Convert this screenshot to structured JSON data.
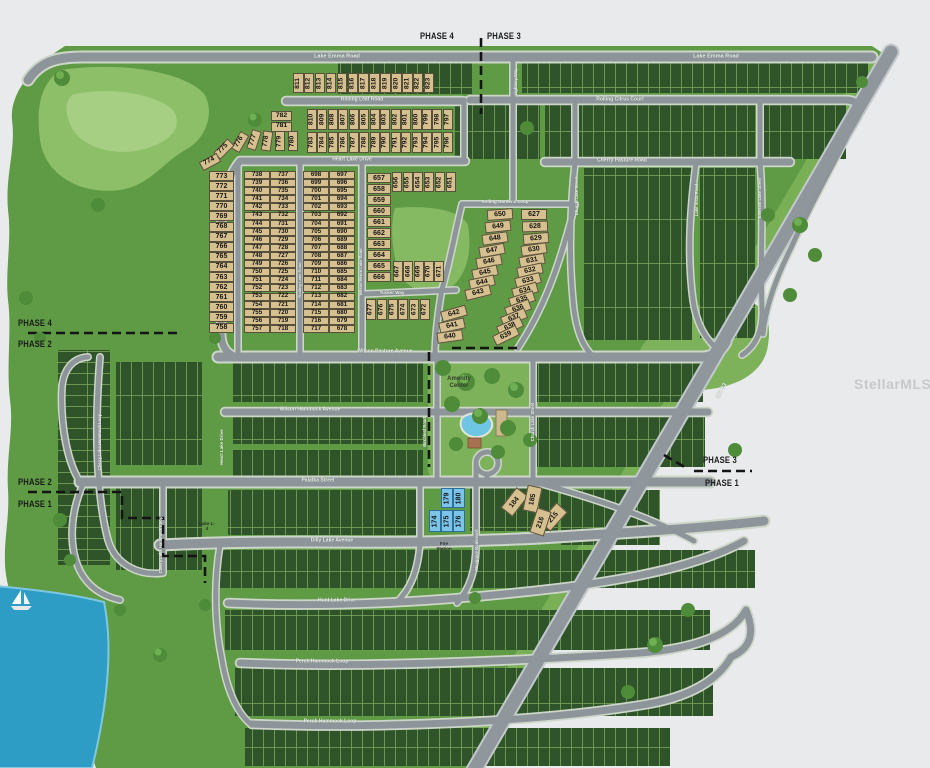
{
  "watermark": "StellarMLS",
  "phases": {
    "top": {
      "left": "PHASE 4",
      "right": "PHASE 3"
    },
    "left_upper": {
      "top": "PHASE 4",
      "bottom": "PHASE 2"
    },
    "left_lower": {
      "top": "PHASE 2",
      "bottom": "PHASE 1"
    },
    "right": {
      "top": "PHASE 3",
      "bottom": "PHASE 1"
    }
  },
  "legend_colors": {
    "available_lot": "#d7c08f",
    "highlighted_lot": "#7cc5e9",
    "sold_lot": "#2f5429",
    "road": "#8d959a",
    "water": "#2d9dc6"
  },
  "streets": [
    {
      "t": "Lake Emma Road",
      "x": 337,
      "y": 57,
      "s": 5.5
    },
    {
      "t": "Lake Emma Road",
      "x": 716,
      "y": 57,
      "s": 5.5
    },
    {
      "t": "Rolling Leaf Road",
      "x": 362,
      "y": 100,
      "s": 5
    },
    {
      "t": "Heart Lake Drive",
      "x": 352,
      "y": 160,
      "s": 5
    },
    {
      "t": "Rolling Citrus Court",
      "x": 620,
      "y": 100,
      "s": 5
    },
    {
      "t": "Cherry Pasture Road",
      "x": 622,
      "y": 161,
      "s": 5
    },
    {
      "t": "Rolling Gardens Loop",
      "x": 505,
      "y": 202,
      "s": 4.5
    },
    {
      "t": "Tucker Way",
      "x": 392,
      "y": 293,
      "s": 4.5
    },
    {
      "t": "Wilson Pasture Avenue",
      "x": 385,
      "y": 352,
      "s": 5
    },
    {
      "t": "Wilson Hammock Avenue",
      "x": 310,
      "y": 410,
      "s": 5
    },
    {
      "t": "Palatka Street",
      "x": 318,
      "y": 481,
      "s": 5
    },
    {
      "t": "Dilly Lake Avenue",
      "x": 332,
      "y": 541,
      "s": 5
    },
    {
      "t": "Hunt Lake Drive",
      "x": 337,
      "y": 601,
      "s": 5
    },
    {
      "t": "Perch Hammock Loop",
      "x": 322,
      "y": 662,
      "s": 5
    },
    {
      "t": "Perch Hammock Loop",
      "x": 330,
      "y": 722,
      "s": 5
    },
    {
      "t": "Cherry Lake Hammock Loop",
      "x": 100,
      "y": 442,
      "r": -90,
      "s": 4.2
    },
    {
      "t": "Cherry Lake Hammock Loop",
      "x": 161,
      "y": 545,
      "r": -90,
      "s": 4.2
    },
    {
      "t": "Heart Lake Drive",
      "x": 222,
      "y": 447,
      "r": -90,
      "s": 4.5
    },
    {
      "t": "Church Lake Street",
      "x": 577,
      "y": 196,
      "r": -90,
      "s": 4.2
    },
    {
      "t": "Church Lake Street",
      "x": 533,
      "y": 422,
      "r": -90,
      "s": 4.2
    },
    {
      "t": "Lake Vista Road",
      "x": 697,
      "y": 200,
      "r": -90,
      "s": 4.2
    },
    {
      "t": "Emerald Lake Street",
      "x": 760,
      "y": 198,
      "r": -90,
      "s": 4.2
    },
    {
      "t": "Lightsey Way",
      "x": 516,
      "y": 82,
      "r": -90,
      "s": 4.2
    },
    {
      "t": "Musgrave Boulevard",
      "x": 477,
      "y": 550,
      "r": -90,
      "s": 4.2
    },
    {
      "t": "Rolling Lane Road",
      "x": 300,
      "y": 280,
      "r": -90,
      "s": 4
    },
    {
      "t": "Wilson Heron Lake Road",
      "x": 361,
      "y": 272,
      "r": -90,
      "s": 4
    },
    {
      "t": "Birchleaf Road",
      "x": 425,
      "y": 432,
      "r": -90,
      "s": 4.2
    },
    {
      "t": "SR 33",
      "x": 722,
      "y": 391,
      "r": -62,
      "s": 6
    }
  ],
  "labels": [
    {
      "t": "Amenity Center",
      "x": 459,
      "y": 383,
      "s": 6,
      "w": 42,
      "c": "#333d2c"
    },
    {
      "t": "Fire Station",
      "x": 444,
      "y": 546,
      "s": 4.5,
      "w": 20,
      "c": "#2e2e2e"
    },
    {
      "t": "Lake L-4",
      "x": 207,
      "y": 526,
      "s": 4.5,
      "w": 18,
      "c": "#2e2e2e"
    }
  ],
  "lots": {
    "groups": [
      {
        "o": "v",
        "st": "a",
        "from": 811,
        "to": 823,
        "x": 293,
        "y": 73,
        "dx": 10.9,
        "w": 10.5,
        "h": 20,
        "fs": 6.8
      },
      {
        "o": "v",
        "st": "a",
        "from": 810,
        "to": 797,
        "x": 307,
        "y": 109,
        "dx": 10.45,
        "w": 10,
        "h": 21,
        "fs": 6.8
      },
      {
        "o": "v",
        "st": "a",
        "from": 783,
        "to": 796,
        "x": 307,
        "y": 132,
        "dx": 10.45,
        "w": 10,
        "h": 21,
        "fs": 6.8
      },
      {
        "o": "h",
        "st": "a",
        "nums": [
          782,
          781
        ],
        "x": 271,
        "y": 111,
        "dy": 10.5,
        "w": 21,
        "h": 10,
        "fs": 6.8
      },
      {
        "o": "v",
        "st": "a",
        "w": 10,
        "h": 20,
        "fs": 6.8,
        "items": [
          {
            "n": 780,
            "x": 288,
            "y": 131
          },
          {
            "n": 779,
            "x": 275,
            "y": 131
          },
          {
            "n": 778,
            "x": 262,
            "y": 131,
            "r": 8
          },
          {
            "n": 777,
            "x": 249,
            "y": 130,
            "r": 18
          },
          {
            "n": 776,
            "x": 235,
            "y": 132,
            "r": 30
          },
          {
            "n": 775,
            "x": 219,
            "y": 139,
            "r": 45
          },
          {
            "n": 774,
            "x": 205,
            "y": 152,
            "r": 62
          }
        ]
      },
      {
        "o": "h",
        "st": "a",
        "from": 773,
        "to": 758,
        "x": 209,
        "y": 171,
        "dy": 10.1,
        "w": 25,
        "h": 10,
        "fs": 7
      },
      {
        "o": "h",
        "st": "a",
        "from": 738,
        "to": 757,
        "x": 244,
        "y": 171,
        "dy": 8.1,
        "w": 26,
        "h": 8,
        "fs": 6.2
      },
      {
        "o": "h",
        "st": "a",
        "from": 737,
        "to": 718,
        "x": 270,
        "y": 171,
        "dy": 8.1,
        "w": 26,
        "h": 8,
        "fs": 6.2
      },
      {
        "o": "h",
        "st": "a",
        "from": 698,
        "to": 717,
        "x": 303,
        "y": 171,
        "dy": 8.1,
        "w": 26,
        "h": 8,
        "fs": 6.2
      },
      {
        "o": "h",
        "st": "a",
        "from": 697,
        "to": 678,
        "x": 329,
        "y": 171,
        "dy": 8.1,
        "w": 26,
        "h": 8,
        "fs": 6.2
      },
      {
        "o": "h",
        "st": "a",
        "from": 657,
        "to": 666,
        "x": 367,
        "y": 173,
        "dy": 11,
        "w": 24,
        "h": 10,
        "fs": 7
      },
      {
        "o": "v",
        "st": "a",
        "from": 656,
        "to": 651,
        "x": 392,
        "y": 172,
        "dx": 10.7,
        "w": 10,
        "h": 20,
        "fs": 6.8
      },
      {
        "o": "v",
        "st": "a",
        "from": 667,
        "to": 671,
        "x": 393,
        "y": 261,
        "dx": 10.3,
        "w": 10,
        "h": 21,
        "fs": 6.8
      },
      {
        "o": "v",
        "st": "a",
        "from": 677,
        "to": 672,
        "x": 366,
        "y": 299,
        "dx": 10.8,
        "w": 10,
        "h": 21,
        "fs": 6.8
      },
      {
        "o": "h",
        "st": "a",
        "w": 26,
        "h": 11,
        "fs": 7,
        "items": [
          {
            "n": 650,
            "x": 487,
            "y": 209,
            "r": -4
          },
          {
            "n": 649,
            "x": 485,
            "y": 221,
            "r": -6
          },
          {
            "n": 648,
            "x": 482,
            "y": 233,
            "r": -8
          },
          {
            "n": 647,
            "x": 479,
            "y": 245,
            "r": -10
          },
          {
            "n": 646,
            "x": 476,
            "y": 256,
            "r": -10
          },
          {
            "n": 645,
            "x": 472,
            "y": 267,
            "r": -12
          },
          {
            "n": 644,
            "x": 469,
            "y": 277,
            "r": -12
          },
          {
            "n": 643,
            "x": 465,
            "y": 287,
            "r": -14
          }
        ]
      },
      {
        "o": "h",
        "st": "a",
        "w": 26,
        "h": 11,
        "fs": 7,
        "items": [
          {
            "n": 627,
            "x": 521,
            "y": 209,
            "r": 0
          },
          {
            "n": 628,
            "x": 522,
            "y": 221,
            "r": -2
          },
          {
            "n": 629,
            "x": 523,
            "y": 233,
            "r": -5
          },
          {
            "n": 630,
            "x": 521,
            "y": 244,
            "r": -8
          },
          {
            "n": 631,
            "x": 519,
            "y": 255,
            "r": -10
          },
          {
            "n": 632,
            "x": 517,
            "y": 265,
            "r": -12
          },
          {
            "n": 633,
            "x": 515,
            "y": 275,
            "r": -14
          },
          {
            "n": 634,
            "x": 512,
            "y": 285,
            "r": -16
          },
          {
            "n": 635,
            "x": 509,
            "y": 294,
            "r": -18
          },
          {
            "n": 636,
            "x": 505,
            "y": 303,
            "r": -20
          },
          {
            "n": 637,
            "x": 501,
            "y": 312,
            "r": -22
          },
          {
            "n": 638,
            "x": 497,
            "y": 321,
            "r": -24
          },
          {
            "n": 639,
            "x": 493,
            "y": 330,
            "r": -26
          }
        ]
      },
      {
        "o": "h",
        "st": "a",
        "w": 26,
        "h": 11,
        "fs": 7,
        "items": [
          {
            "n": 642,
            "x": 441,
            "y": 308,
            "r": -16
          },
          {
            "n": 641,
            "x": 439,
            "y": 320,
            "r": -12
          },
          {
            "n": 640,
            "x": 437,
            "y": 331,
            "r": -8
          }
        ]
      },
      {
        "o": "v",
        "st": "b",
        "nums": [
          179,
          180
        ],
        "x": 441,
        "y": 488,
        "dx": 12,
        "w": 11.5,
        "h": 20,
        "fs": 7
      },
      {
        "o": "v",
        "st": "b",
        "nums": [
          174,
          175,
          176
        ],
        "x": 429,
        "y": 510,
        "dx": 12,
        "w": 11.5,
        "h": 22,
        "fs": 7
      },
      {
        "o": "v",
        "st": "a",
        "w": 15,
        "h": 26,
        "fs": 7,
        "items": [
          {
            "n": 184,
            "x": 507,
            "y": 489,
            "r": 38
          },
          {
            "n": 185,
            "x": 525,
            "y": 486,
            "r": 12
          },
          {
            "n": 215,
            "x": 546,
            "y": 504,
            "r": 42
          },
          {
            "n": 216,
            "x": 533,
            "y": 509,
            "r": 18
          }
        ]
      }
    ]
  }
}
